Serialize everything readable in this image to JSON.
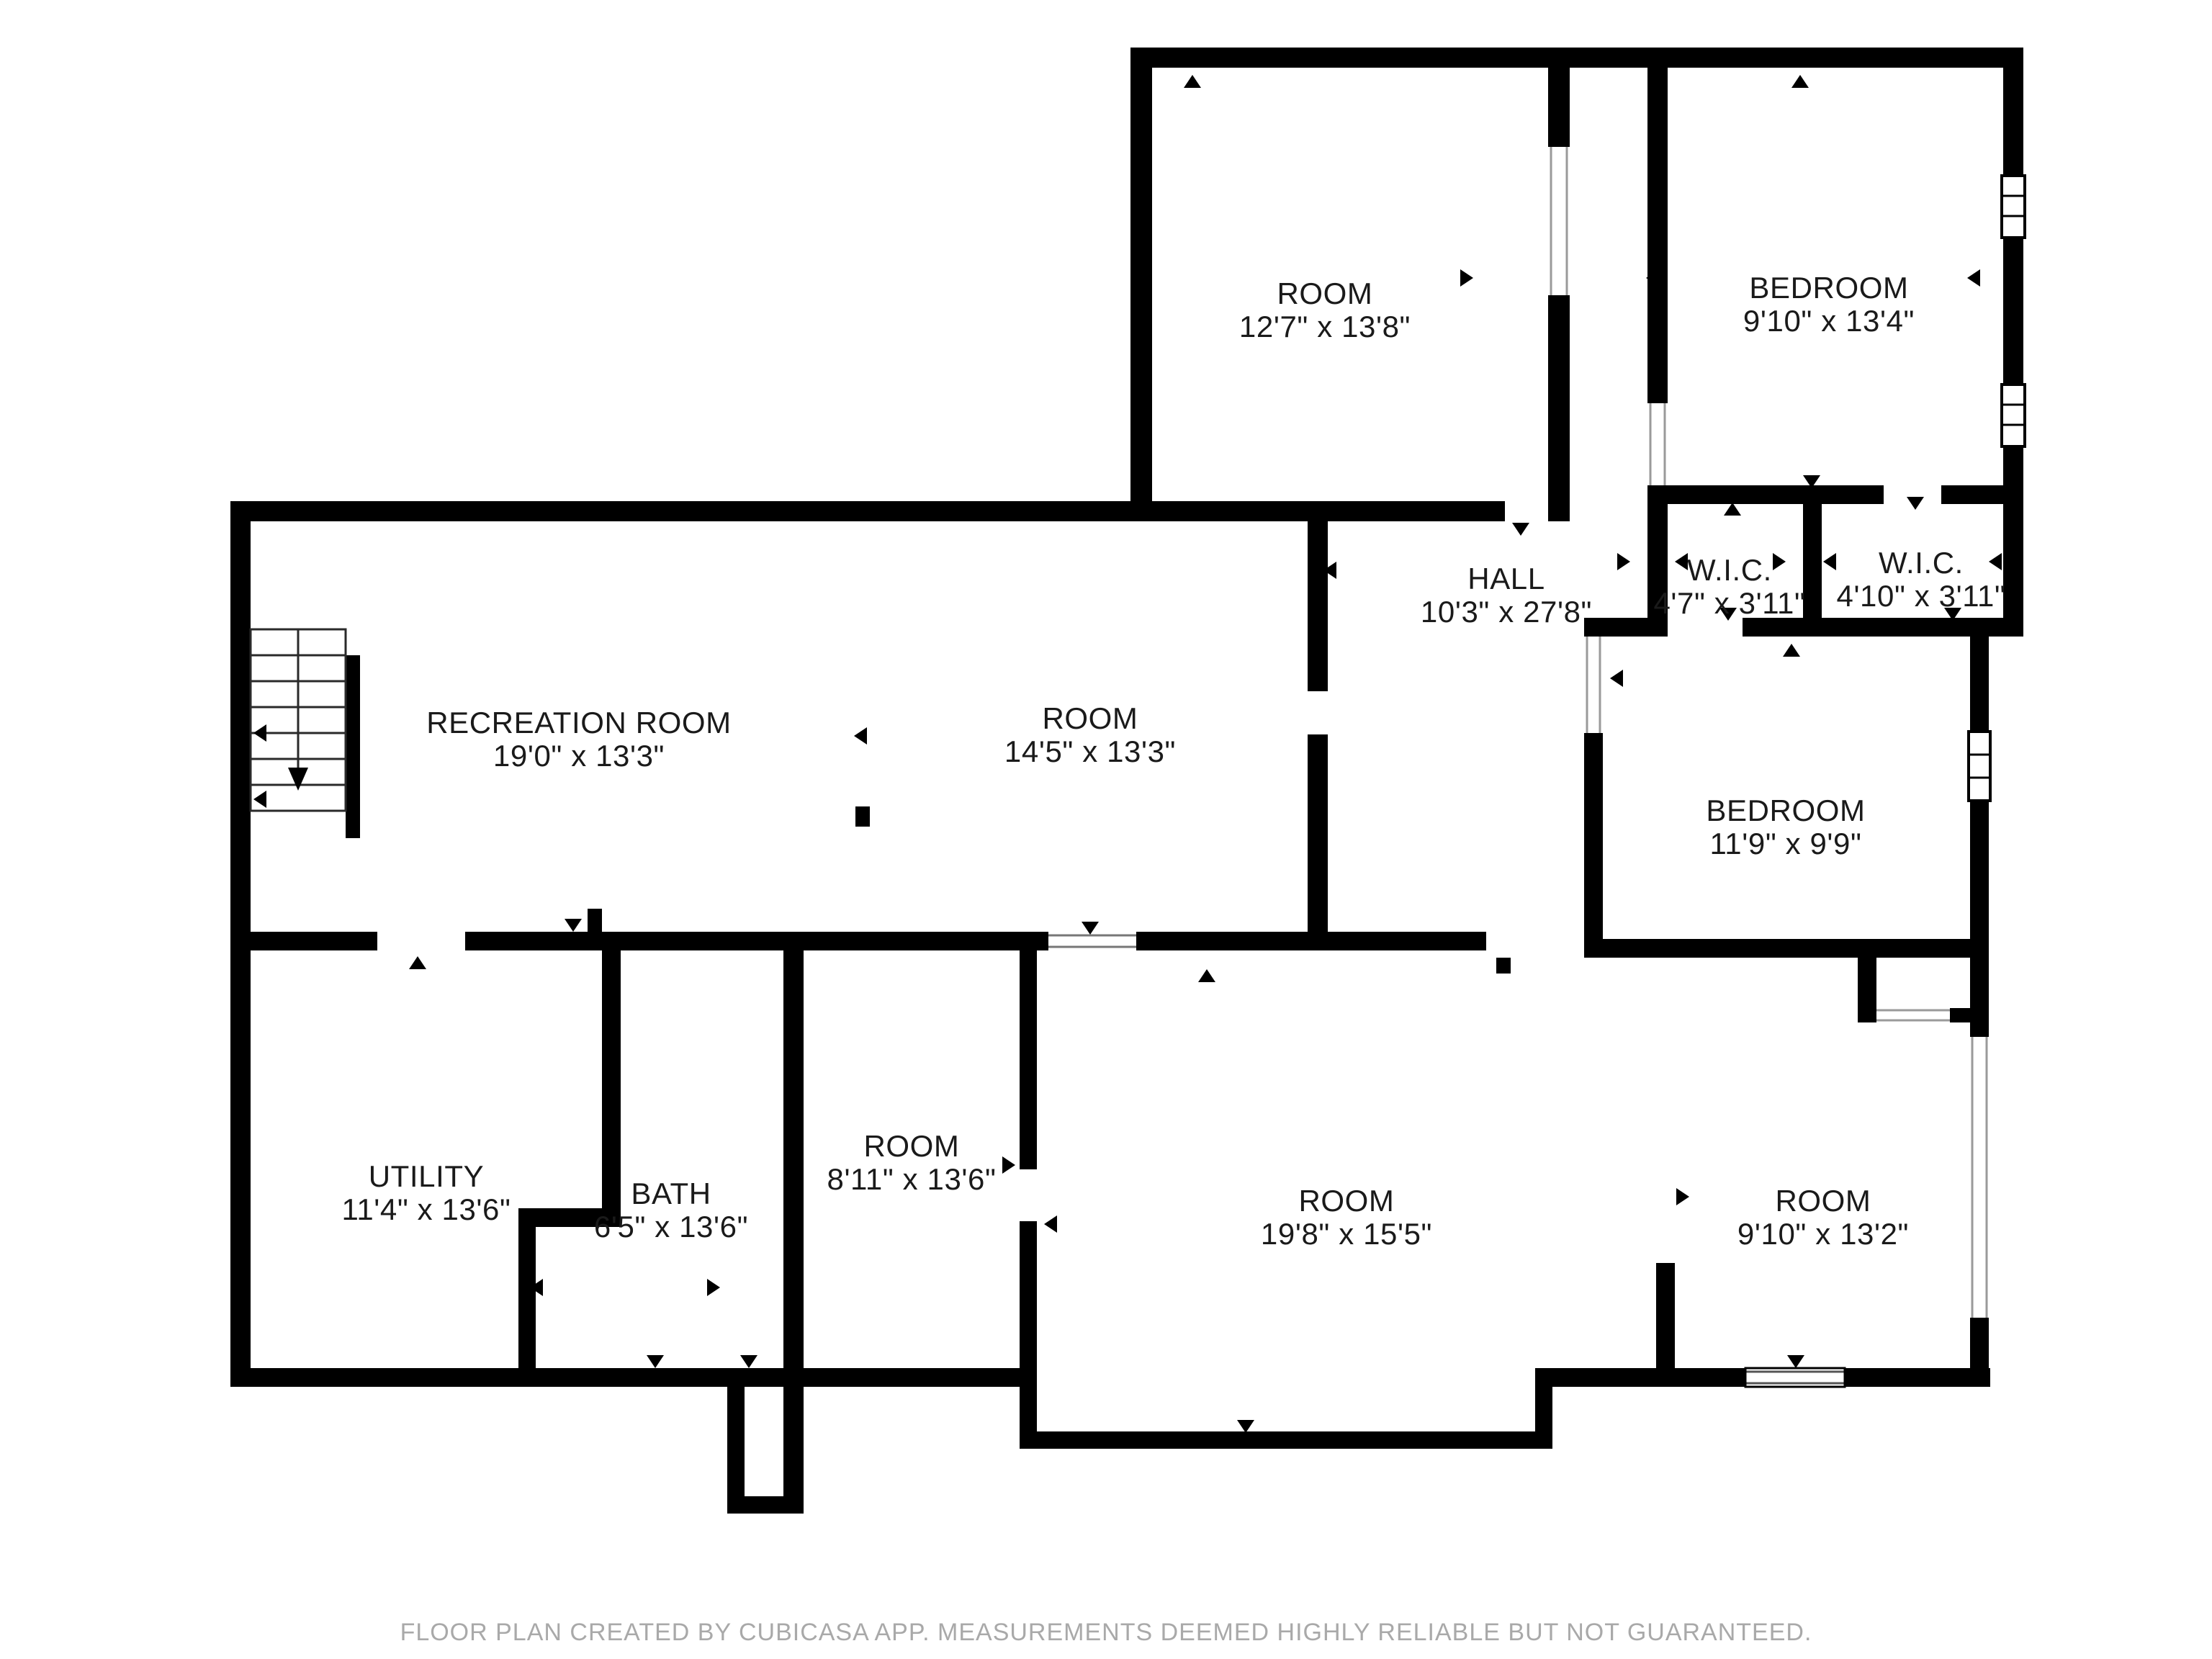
{
  "plan": {
    "creator_note": "FLOOR PLAN CREATED BY CUBICASA APP. MEASUREMENTS DEEMED HIGHLY RELIABLE BUT NOT GUARANTEED."
  },
  "rooms": [
    {
      "name": "ROOM",
      "dims": "12'7\" x 13'8\""
    },
    {
      "name": "BEDROOM",
      "dims": "9'10\" x 13'4\""
    },
    {
      "name": "HALL",
      "dims": "10'3\" x 27'8\""
    },
    {
      "name": "W.I.C.",
      "dims": "4'7\" x 3'11\""
    },
    {
      "name": "W.I.C.",
      "dims": "4'10\" x 3'11\""
    },
    {
      "name": "RECREATION ROOM",
      "dims": "19'0\" x 13'3\""
    },
    {
      "name": "ROOM",
      "dims": "14'5\" x 13'3\""
    },
    {
      "name": "BEDROOM",
      "dims": "11'9\" x 9'9\""
    },
    {
      "name": "UTILITY",
      "dims": "11'4\" x 13'6\""
    },
    {
      "name": "BATH",
      "dims": "6'5\" x 13'6\""
    },
    {
      "name": "ROOM",
      "dims": "8'11\" x 13'6\""
    },
    {
      "name": "ROOM",
      "dims": "19'8\" x 15'5\""
    },
    {
      "name": "ROOM",
      "dims": "9'10\" x 13'2\""
    }
  ],
  "colors": {
    "wall": "#000000",
    "background": "#ffffff",
    "window_line": "#9a9a9a",
    "label_text": "#1a1a1a",
    "footer_text": "#a9a9a9"
  }
}
